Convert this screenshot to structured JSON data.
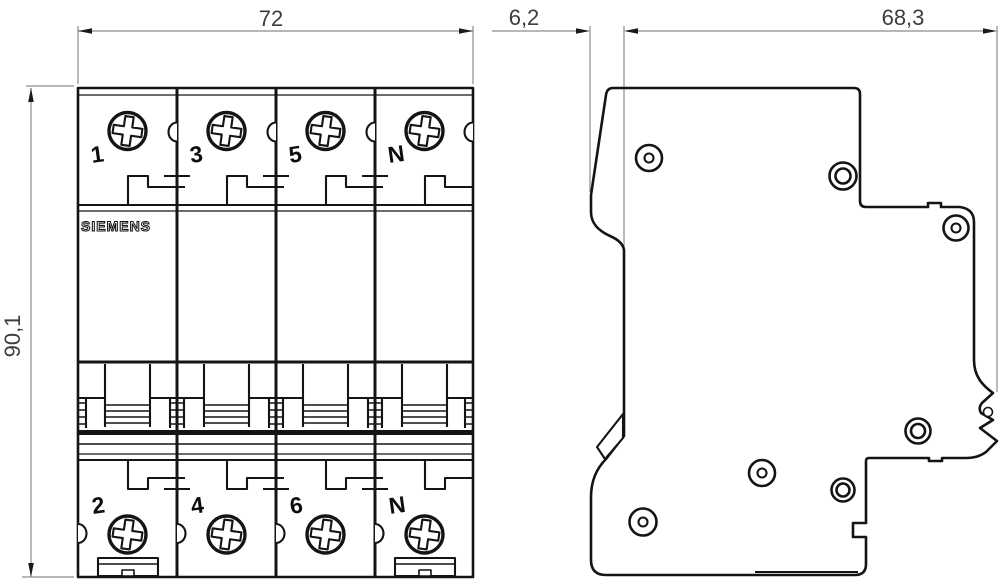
{
  "drawing": {
    "brand": "SIEMENS",
    "dimensions": {
      "width_mm": "72",
      "height_mm": "90,1",
      "din_offset_mm": "6,2",
      "depth_mm": "68,3"
    },
    "front_view": {
      "top_terminals": [
        "1",
        "3",
        "5",
        "N"
      ],
      "bottom_terminals": [
        "2",
        "4",
        "6",
        "N"
      ]
    },
    "colors": {
      "line": "#141414",
      "dimension_line": "#8c8c8c",
      "background": "#ffffff"
    }
  }
}
